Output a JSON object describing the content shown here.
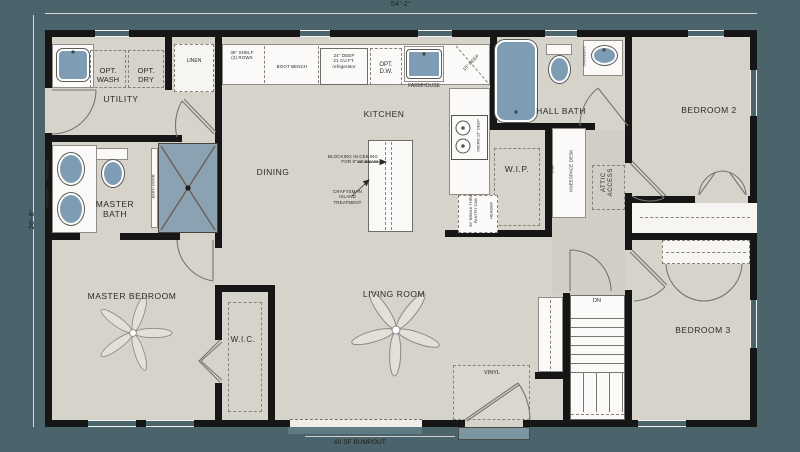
{
  "dimensions": {
    "width": "54'-2\"",
    "depth": "26'-8\"",
    "bumpout": "60 SF BUMPOUT"
  },
  "rooms": {
    "utility": "UTILITY",
    "master_bath": [
      "MASTER",
      "BATH"
    ],
    "dining": "DINING",
    "kitchen": "KITCHEN",
    "wip": "W.I.P.",
    "hall_bath": "HALL BATH",
    "bedroom2": "BEDROOM 2",
    "master_bedroom": "MASTER BEDROOM",
    "wic": "W.I.C.",
    "living_room": "LIVING ROOM",
    "bedroom3": "BEDROOM 3"
  },
  "labels": {
    "opt_wash": [
      "OPT.",
      "WASH"
    ],
    "opt_dry": [
      "OPT.",
      "DRY"
    ],
    "linen": "LINEN",
    "shelf": [
      "36\" SHELF",
      "(2) ROWS"
    ],
    "boot_bench": "BOOT BENCH",
    "refrigerator": [
      "24\" DEEP",
      "21 CU.FT.",
      "refrigerator"
    ],
    "opt_dw": [
      "OPT.",
      "D.W."
    ],
    "farmhouse": "FARMHOUSE",
    "corner_cab": "15\" DEEP",
    "micro": "MICRO 15\" DEEP",
    "pantry_cab": [
      "30\" BREAK THRU",
      "PANTRY CAB"
    ],
    "header": "HEADER",
    "usb": "USB",
    "kneespace": "KNEESPACE DESK",
    "attic_access": [
      "ATTIC",
      "ACCESS"
    ],
    "barn_door": "BARN DOOR",
    "drawers": "DRAWERS",
    "vinyl": "VINYL",
    "down": "DN"
  },
  "annotations": {
    "blocking": [
      "BLOCKING IN CEILING",
      "FOR 8\"x8\" BEAM"
    ],
    "island": [
      "CRAFTSMAN",
      "ISLAND",
      "TREATMENT"
    ]
  },
  "colors": {
    "background": "#4b636a",
    "floor": "#d6d3ca",
    "wall": "#161616",
    "fixture_blue": "#7e9db5",
    "shower_blue": "#8aa2b2"
  }
}
